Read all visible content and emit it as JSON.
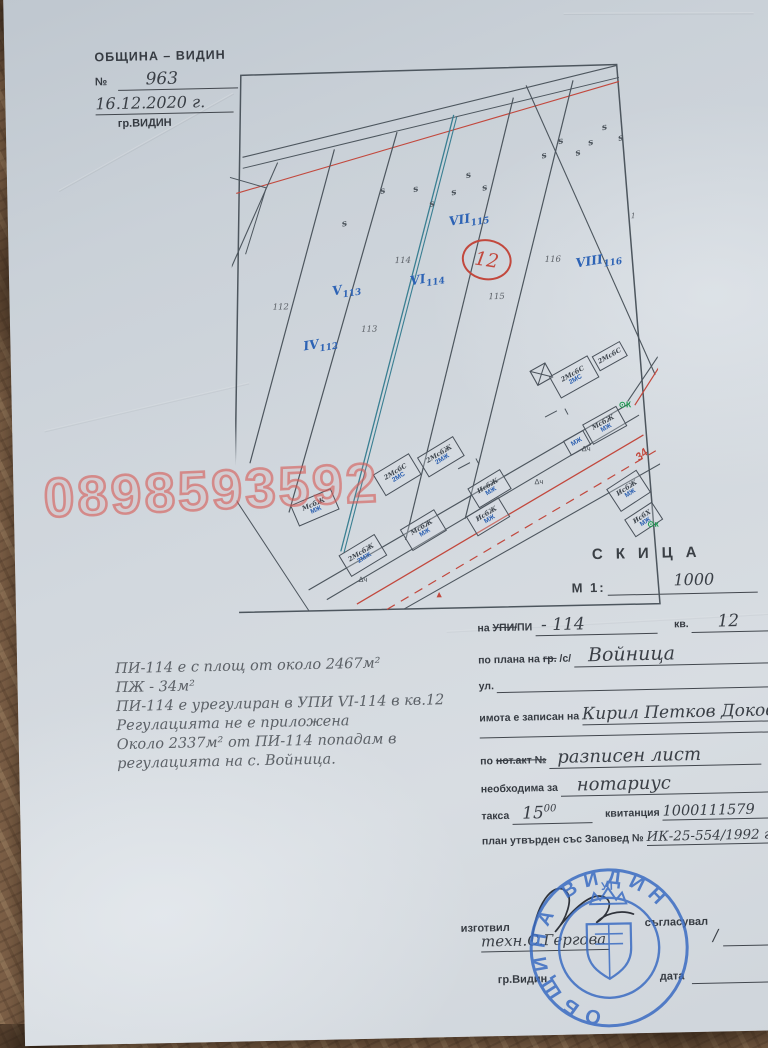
{
  "office_stamp": {
    "org": "ОБЩИНА – ВИДИН",
    "no_label": "№",
    "no_value": "963",
    "date_value": "16.12.2020 г.",
    "city": "гр.ВИДИН"
  },
  "watermark": "0898593592",
  "map": {
    "veg_symbol": "s",
    "quarter_circle": "12",
    "street_no": "34",
    "ok1": "⊙К",
    "ok2": "⊙к",
    "tri": "Δч",
    "red_tri": "▲",
    "one": "1",
    "pencil": {
      "p112": "112",
      "p113": "113",
      "p114": "114",
      "p115": "115",
      "p116": "116"
    },
    "upi": [
      {
        "r": "IV",
        "n": "112"
      },
      {
        "r": "V",
        "n": "113"
      },
      {
        "r": "VI",
        "n": "114"
      },
      {
        "r": "VII",
        "n": "115"
      },
      {
        "r": "VIII",
        "n": "116"
      }
    ],
    "buildings": [
      {
        "t": "2МсбС",
        "b": "2МС"
      },
      {
        "t": "2МсбС",
        "b": "2МС"
      },
      {
        "t": "МсбЖ",
        "b": "МЖ"
      },
      {
        "t": "МсбЖ",
        "b": "МЖ"
      },
      {
        "t": "2МсбС",
        "b": "2МС"
      },
      {
        "t": "2МсбЖ",
        "b": "2МЖ"
      },
      {
        "t": "ИсбЖ",
        "b": "МЖ"
      },
      {
        "t": "ИсбЖ",
        "b": "МЖ"
      },
      {
        "t": "МсбЖ",
        "b": "МЖ"
      },
      {
        "t": "2МсбЖ",
        "b": "2МЖ"
      },
      {
        "t": "МсбЖ",
        "b": "МЖ"
      },
      {
        "t": "ИсбЖ",
        "b": "МЖ"
      },
      {
        "t": "ИсбХ",
        "b": "МЖ"
      }
    ]
  },
  "skica": {
    "title": "СКИЦА",
    "scale_label": "М 1:",
    "scale_value": "1000"
  },
  "form": {
    "upi_label_pre": "на ",
    "upi_label_strike": "УПИ/",
    "upi_label_post": "ПИ",
    "upi_value": "- 114",
    "kv_label": "кв.",
    "kv_value": "12",
    "plan_label": "по плана на",
    "plan_strike": "гр.",
    "plan_label2": "/с/",
    "plan_value": "Войница",
    "street_label": "ул.",
    "owner_label": "имота е записан на",
    "owner_value": "Кирил Петков Доков",
    "deed_label_pre": "по ",
    "deed_label_strike": "нот.акт №",
    "deed_value": "разписен лист",
    "needed_label": "необходима за",
    "needed_value": "нотариус",
    "fee_label": "такса",
    "fee_value": "15",
    "fee_sup": "00",
    "receipt_label": "квитанция",
    "receipt_value": "1000111579",
    "order_label": "план утвърден със Заповед №",
    "order_value": "ИК-25-554/1992 г."
  },
  "notes": {
    "l1": "ПИ-114 е с площ от около 2467м²",
    "l2": "ПЖ - 34м²",
    "l3": "ПИ-114 е урегулиран в УПИ VI-114 в кв.12",
    "l4": "Регулацията не е приложена",
    "l5": "Около 2337м² от ПИ-114 попадам в",
    "l6": "регулацията на с. Войница."
  },
  "footer": {
    "prepared_label": "изготвил",
    "prepared_by": "техн.С.Гергова",
    "approved_label": "съгласувал",
    "approved_value": "/",
    "city": "гр.Видин",
    "date_label": "дата"
  },
  "seal": {
    "ring": "ОБЩИНА ВИДИН",
    "top": "УТ"
  }
}
